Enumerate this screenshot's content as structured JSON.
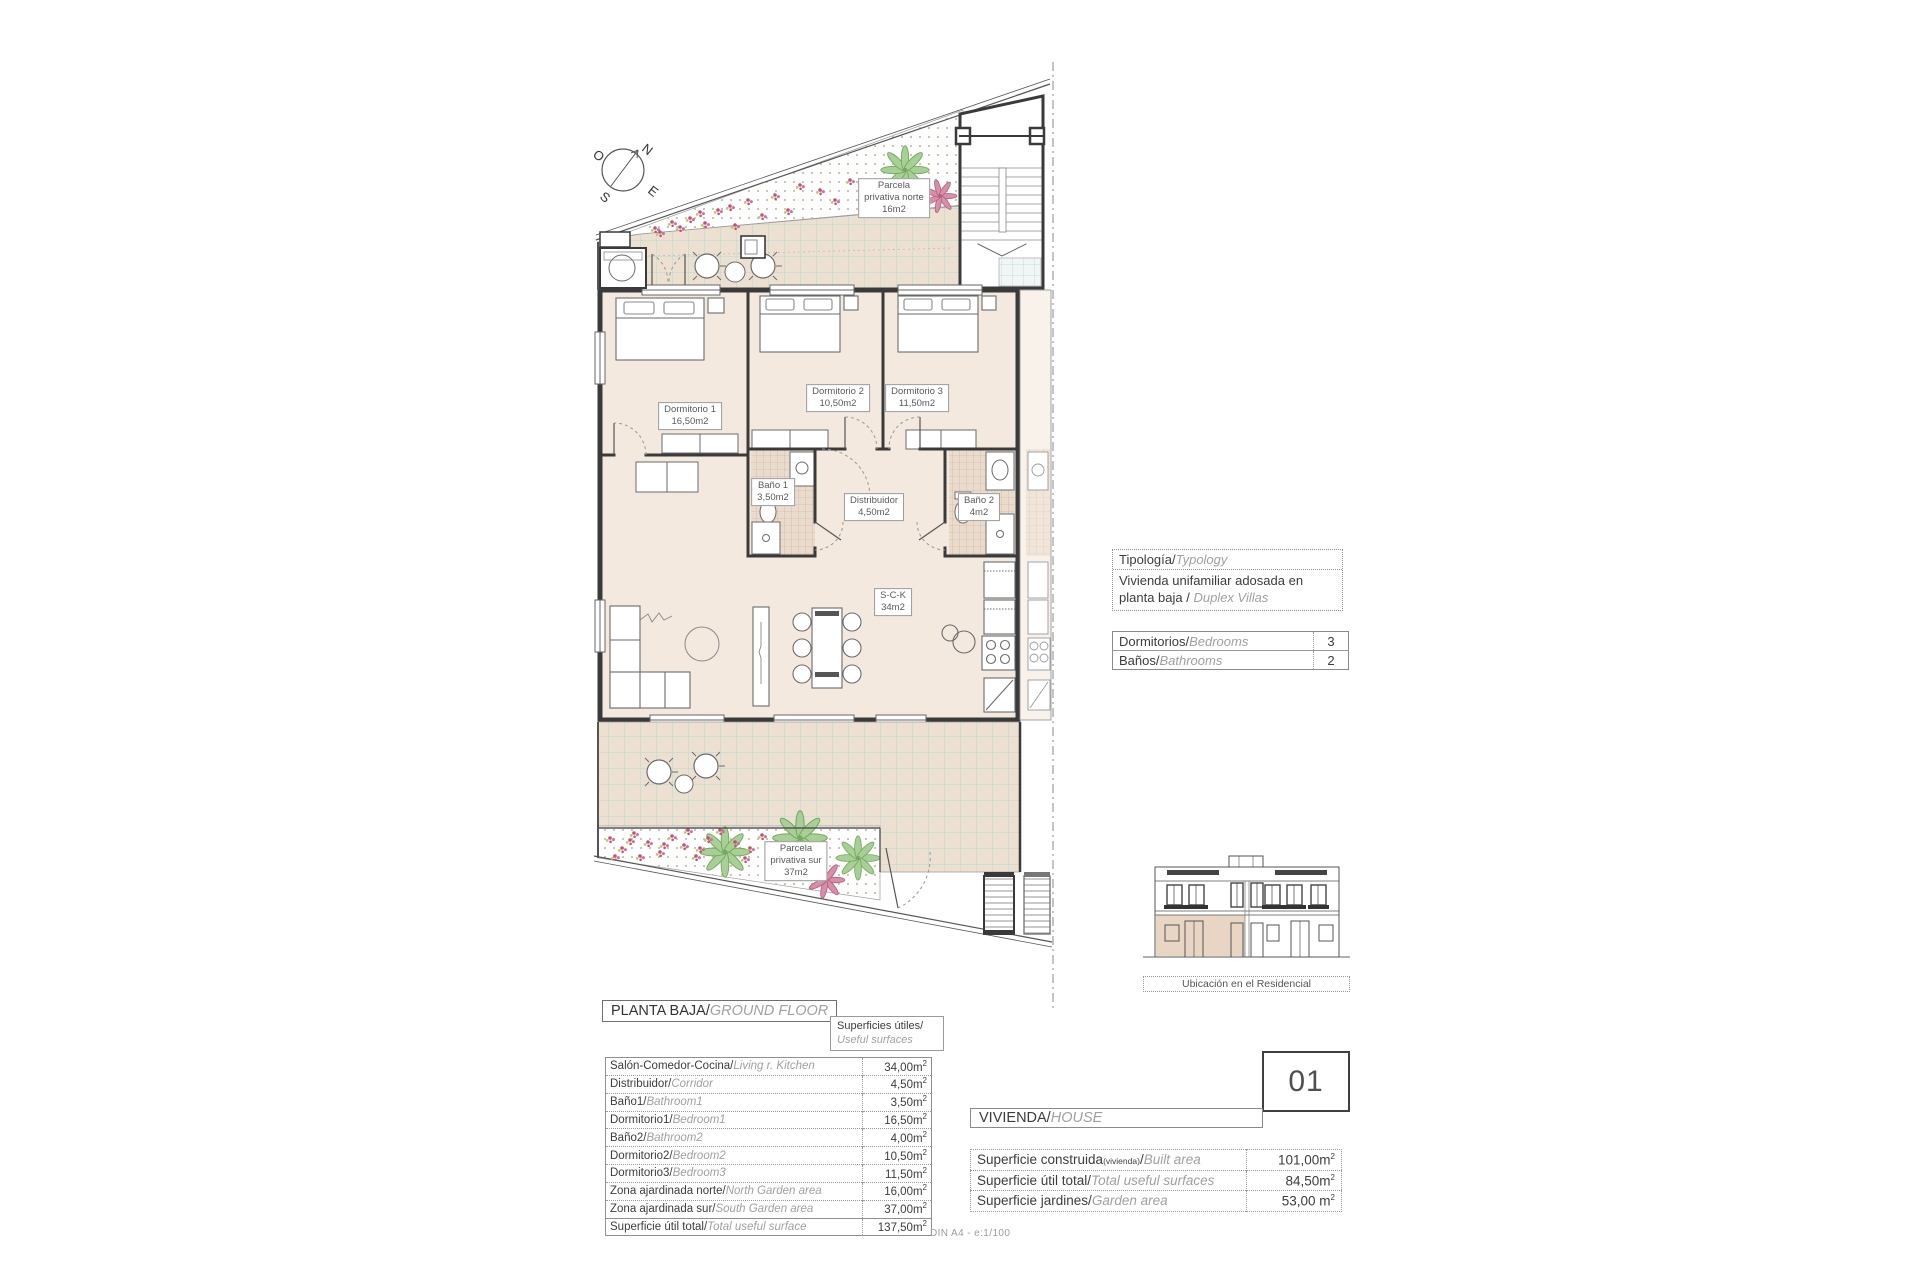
{
  "colors": {
    "wall": "#3a3a3a",
    "room_fill": "#f3e9df",
    "terrace_tile": "#ece1d1",
    "terrace_grid": "#b9d7d0",
    "bath_tile_line": "#d0a79c",
    "plant_green": "#a8cf96",
    "flower_pink": "#d68fa8",
    "elevation_highlight": "#e8d5c3"
  },
  "compass": {
    "n": "N",
    "e": "E",
    "s": "S",
    "w": "O"
  },
  "plan": {
    "rooms": [
      {
        "name": "Dormitorio 1",
        "area": "16,50m2"
      },
      {
        "name": "Dormitorio 2",
        "area": "10,50m2"
      },
      {
        "name": "Dormitorio 3",
        "area": "11,50m2"
      },
      {
        "name": "Baño 1",
        "area": "3,50m2"
      },
      {
        "name": "Baño 2",
        "area": "4m2"
      },
      {
        "name": "Distribuidor",
        "area": "4,50m2"
      },
      {
        "name": "S-C-K",
        "area": "34m2"
      }
    ],
    "gardens": [
      {
        "l1": "Parcela",
        "l2": "privativa norte",
        "l3": "16m2"
      },
      {
        "l1": "Parcela",
        "l2": "privativa sur",
        "l3": "37m2"
      }
    ]
  },
  "typology": {
    "header_es": "Tipología/",
    "header_en": "Typology",
    "body_es": "Vivienda unifamiliar adosada en planta baja / ",
    "body_en": "Duplex Villas"
  },
  "counts": {
    "rows": [
      {
        "es": "Dormitorios/",
        "en": "Bedrooms",
        "value": "3"
      },
      {
        "es": "Baños/",
        "en": "Bathrooms",
        "value": "2"
      }
    ]
  },
  "elevation": {
    "caption": "Ubicación en el Residencial"
  },
  "ground_floor": {
    "title_es": "PLANTA BAJA/",
    "title_en": "GROUND FLOOR",
    "surfaces_es": "Superficies útiles/",
    "surfaces_en": "Useful surfaces",
    "rows": [
      {
        "es": "Salón-Comedor-Cocina/",
        "en": "Living r. Kitchen",
        "value": "34,00m",
        "sup": "2"
      },
      {
        "es": "Distribuidor/",
        "en": "Corridor",
        "value": "4,50m",
        "sup": "2"
      },
      {
        "es": "Baño1/",
        "en": "Bathroom1",
        "value": "3,50m",
        "sup": "2"
      },
      {
        "es": "Dormitorio1/",
        "en": "Bedroom1",
        "value": "16,50m",
        "sup": "2"
      },
      {
        "es": "Baño2/",
        "en": "Bathroom2",
        "value": "4,00m",
        "sup": "2"
      },
      {
        "es": "Dormitorio2/",
        "en": "Bedroom2",
        "value": "10,50m",
        "sup": "2"
      },
      {
        "es": "Dormitorio3/",
        "en": "Bedroom3",
        "value": "11,50m",
        "sup": "2"
      },
      {
        "es": "Zona ajardinada norte/",
        "en": "North Garden area",
        "value": "16,00m",
        "sup": "2"
      },
      {
        "es": "Zona ajardinada sur/",
        "en": "South Garden area",
        "value": "37,00m",
        "sup": "2"
      },
      {
        "es": "Superficie útil total/",
        "en": "Total useful surface",
        "value": "137,50m",
        "sup": "2"
      }
    ]
  },
  "house": {
    "number": "01",
    "label_es": "VIVIENDA/",
    "label_en": "HOUSE",
    "rows": [
      {
        "es": "Superficie construida",
        "sub": "(vivienda)",
        "slash": "/",
        "en": "Built area",
        "value": "101,00m",
        "sup": "2"
      },
      {
        "es": "Superficie útil total/",
        "en": "Total useful surfaces",
        "value": "84,50m",
        "sup": "2"
      },
      {
        "es": "Superficie jardines/",
        "en": "Garden area",
        "value": "53,00 m",
        "sup": "2"
      }
    ]
  },
  "footer": {
    "note": "DIN A4 - e:1/100"
  }
}
